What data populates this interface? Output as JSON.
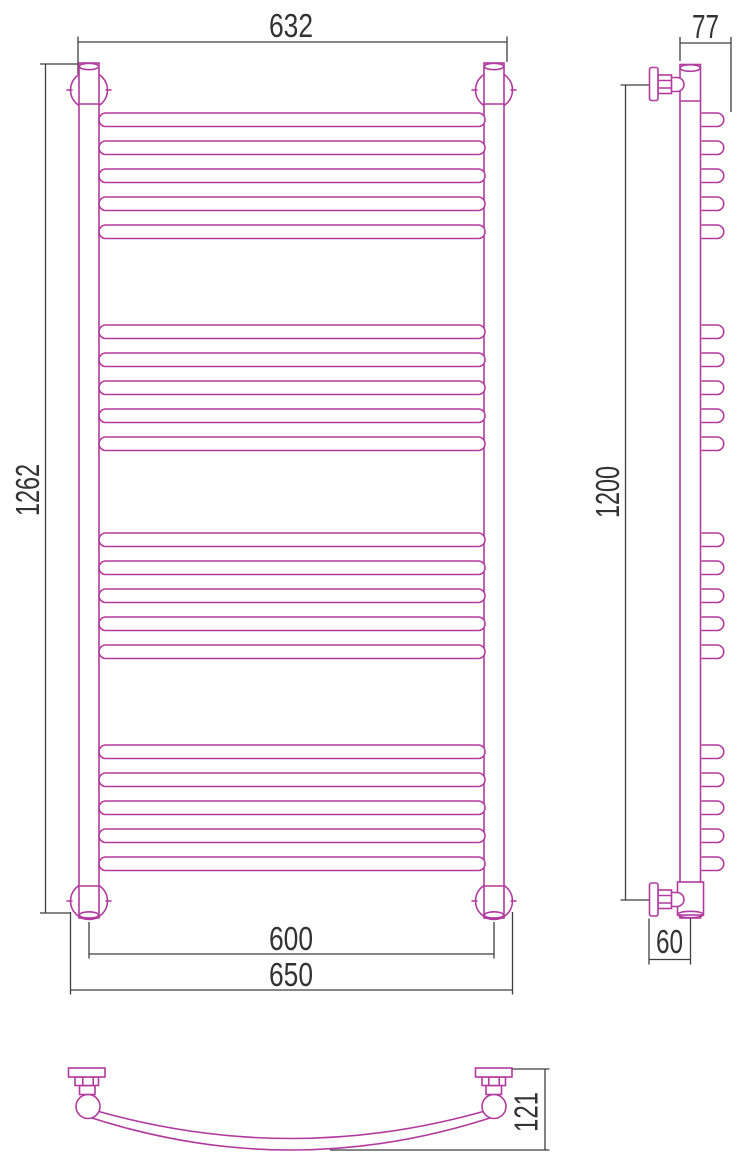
{
  "drawing": {
    "description": "Three-view technical dimension drawing of a curved ladder towel radiator",
    "colors": {
      "product_outline": "#b23a9e",
      "dimension_lines": "#3f3f3f",
      "text": "#333333",
      "background": "#ffffff"
    },
    "structure": {
      "rung_groups": 4,
      "rungs_per_group": 5,
      "total_rungs": 20
    }
  },
  "views": {
    "front": {
      "dims": {
        "overall_width": "632",
        "overall_height": "1262",
        "rail_spacing": "600",
        "mount_width": "650"
      }
    },
    "side": {
      "dims": {
        "depth": "77",
        "mount_height": "1200",
        "bottom_offset": "60"
      }
    },
    "top": {
      "dims": {
        "bow_depth": "121"
      }
    }
  }
}
